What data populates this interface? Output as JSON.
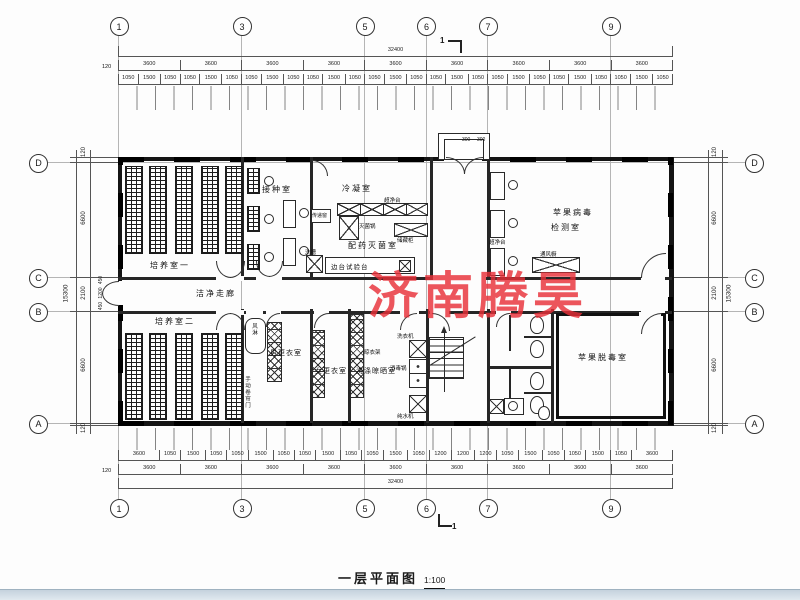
{
  "watermark": {
    "text": "济南腾昊",
    "color": "#e83038"
  },
  "titlebar": {
    "title": "一层平面图",
    "scale": "1:100"
  },
  "section": {
    "top": "1",
    "bottom": "1"
  },
  "grid_bubbles": {
    "top": [
      "1",
      "3",
      "5",
      "6",
      "7",
      "9"
    ],
    "bottom": [
      "1",
      "3",
      "5",
      "6",
      "7",
      "9"
    ],
    "left": [
      "D",
      "C",
      "B",
      "A"
    ],
    "right": [
      "D",
      "C",
      "B",
      "A"
    ]
  },
  "dims": {
    "top_overall": "32400",
    "bottom_overall": "32400",
    "margin": "120",
    "top_bays": [
      "3600",
      "3600",
      "3600",
      "3600",
      "3600",
      "3600",
      "3600",
      "3600",
      "3600"
    ],
    "bottom_bays": [
      "3600",
      "3600",
      "3600",
      "3600",
      "3600",
      "3600",
      "3600",
      "3600",
      "3600"
    ],
    "top_detail": [
      "1050",
      "1500",
      "1050",
      "1050",
      "1500",
      "1050",
      "1050",
      "1500",
      "1050",
      "1050",
      "1500",
      "1050",
      "1050",
      "1500",
      "1050",
      "1050",
      "1500",
      "1050",
      "1050",
      "1500",
      "1050",
      "1050",
      "1500",
      "1050",
      "1050",
      "1500",
      "1050"
    ],
    "bottom_detail": [
      "3600",
      "1050",
      "1500",
      "1050",
      "1050",
      "1500",
      "1050",
      "1050",
      "1500",
      "1050",
      "1050",
      "1500",
      "1050",
      "1200",
      "1200",
      "1200",
      "1050",
      "1500",
      "1050",
      "1050",
      "1500",
      "1050",
      "3600"
    ],
    "left_overall": "15300",
    "right_overall": "15300",
    "left_segments": [
      "120",
      "6600",
      "2100",
      "6600",
      "120"
    ],
    "right_segments": [
      "120",
      "6600",
      "2100",
      "6600",
      "120"
    ],
    "left_sub": [
      "450",
      "1200",
      "450"
    ],
    "porch_depth": "1200",
    "porch_a": "300",
    "porch_b": "300"
  },
  "rooms": {
    "culture1": "培养室一",
    "inoculation": "接种室",
    "condensation": "冷凝室",
    "dispensing": "配药灭菌室",
    "virus1": "苹果病毒",
    "virus2": "检测室",
    "corridor": "洁净走廊",
    "culture2": "培养室二",
    "men": "男更衣室",
    "women": "女更衣室",
    "washing": "洗涤晾晒室",
    "detox": "苹果脱毒室"
  },
  "equipment": {
    "pass_window": "传递窗",
    "autoclave": "灭菌锅",
    "storage": "储藏柜",
    "sink": "洗槽",
    "side_bench": "边台试验台",
    "bench_row": "超净台",
    "clean_bench": "超净台",
    "fume_hood": "通风橱",
    "air_shower": "风淋",
    "drying_rack": "晾衣架",
    "washer": "洗衣机",
    "sterilizer": "消毒锅",
    "purifier": "纯水机",
    "rolling_door": "手动卷帘门"
  }
}
